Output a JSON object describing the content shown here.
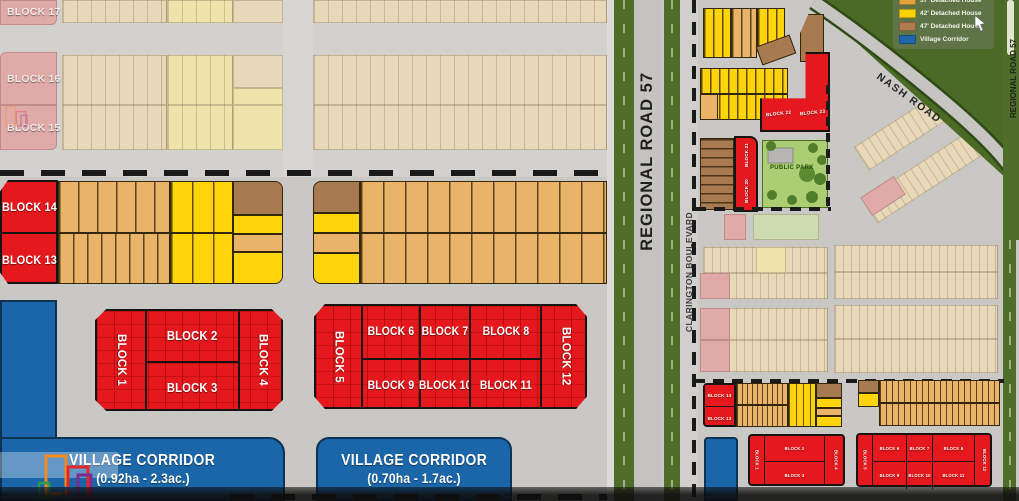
{
  "detail": {
    "b1": "BLOCK 1",
    "b2": "BLOCK 2",
    "b3": "BLOCK 3",
    "b4": "BLOCK 4",
    "b5": "BLOCK 5",
    "b6": "BLOCK 6",
    "b7": "BLOCK 7",
    "b8": "BLOCK 8",
    "b9": "BLOCK 9",
    "b10": "BLOCK 10",
    "b11": "BLOCK 11",
    "b12": "BLOCK 12",
    "b13": "BLOCK 13",
    "b14": "BLOCK 14",
    "b15": "BLOCK 15",
    "b16": "BLOCK 16",
    "b17": "BLOCK 17",
    "vc1_title": "VILLAGE CORRIDOR",
    "vc1_area": "(0.92ha - 2.3ac.)",
    "vc2_title": "VILLAGE CORRIDOR",
    "vc2_area": "(0.70ha - 1.7ac.)"
  },
  "roads": {
    "regional_road_57": "REGIONAL ROAD 57",
    "clarington_boulevard": "CLARINGTON BOULEVARD",
    "nash_road": "NASH ROAD",
    "regional_road_57_right": "REGIONAL ROAD 57"
  },
  "overview": {
    "b20": "BLOCK 20",
    "b21": "BLOCK 21",
    "b22": "BLOCK 22",
    "b23": "BLOCK 23",
    "public_park": "PUBLIC PARK"
  },
  "legend": {
    "items": [
      {
        "label": "37' Detached House",
        "color": "#e2a33c"
      },
      {
        "label": "42' Detached House",
        "color": "#ffd200"
      },
      {
        "label": "47' Detached House",
        "color": "#b07c4f"
      },
      {
        "label": "Village Corridor",
        "color": "#1d66aa"
      }
    ]
  },
  "colors": {
    "lot_red": "#e5191d",
    "lot_tan": "#e9b467",
    "lot_yellow": "#ffd40a",
    "lot_brown": "#a87a50",
    "village_blue": "#1b66a9",
    "road_gray": "#c9c8c5",
    "grass_green": "#4f6c29",
    "park_green": "#abce72"
  }
}
